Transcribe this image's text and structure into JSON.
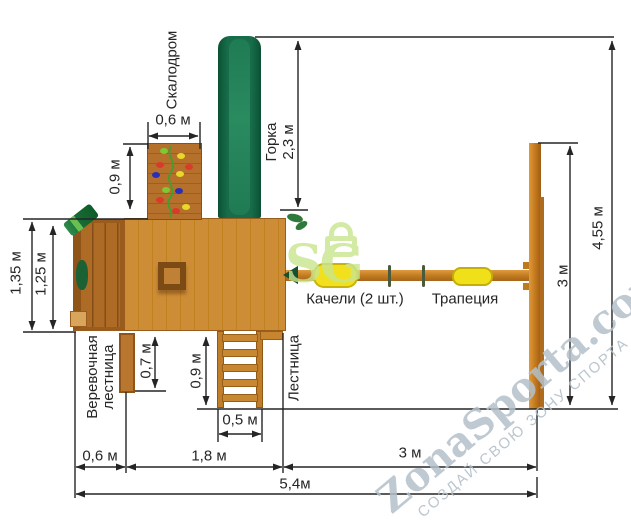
{
  "features": {
    "climbing_wall": "Скалодром",
    "slide_line1": "Горка",
    "slide_line2": "2,3 м",
    "rope_ladder_line1": "Веревочная",
    "rope_ladder_line2": "лестница",
    "ladder": "Лестница",
    "swings": "Качели (2 шт.)",
    "trapeze": "Трапеция"
  },
  "dims": {
    "wall_width": "0,6 м",
    "wall_height": "0,9 м",
    "box_outer": "1,35 м",
    "box_inner": "1,25 м",
    "rope_length": "0,7 м",
    "ladder_length": "0,9 м",
    "ladder_width": "0,5 м",
    "swing_height": "3 м",
    "total_height": "4,55 м",
    "bottom_box": "0,6 м",
    "bottom_platform": "1,8 м",
    "bottom_swing": "3 м",
    "total_width": "5,4м"
  },
  "watermark": {
    "logo": "SG",
    "site": "ZonaSporta.com",
    "slogan": "СОЗДАЙ СВОЮ ЗОНУ СПОРТА"
  },
  "colors": {
    "wood_light": "#cd8c36",
    "wood_dark": "#ad6b26",
    "slide_green": "#176c49",
    "accent_yellow": "#f2e01c",
    "dimension_line": "#252525",
    "watermark_gray_blue": "#b4c0ca",
    "logo_green": "#c9e68f"
  }
}
